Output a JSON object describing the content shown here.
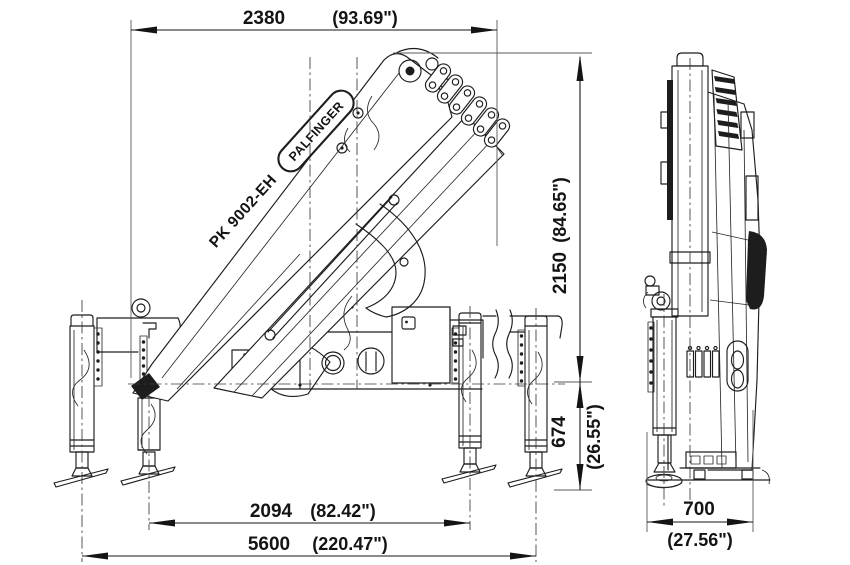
{
  "product": {
    "brand": "PALFINGER",
    "model": "PK 9002-EH"
  },
  "dimensions": {
    "top_width": {
      "mm": "2380",
      "inches": "(93.69\")"
    },
    "overall_height": {
      "mm": "2150",
      "inches": "(84.65\")"
    },
    "frame_to_ground": {
      "mm": "674",
      "inches": "(26.55\")"
    },
    "outrigger_span_inner": {
      "mm": "2094",
      "inches": "(82.42\")"
    },
    "outrigger_span_outer": {
      "mm": "5600",
      "inches": "(220.47\")"
    },
    "front_width": {
      "mm": "700",
      "inches": "(27.56\")"
    }
  },
  "colors": {
    "line": "#1d1d1d",
    "dimension": "#141414",
    "background": "#ffffff"
  }
}
